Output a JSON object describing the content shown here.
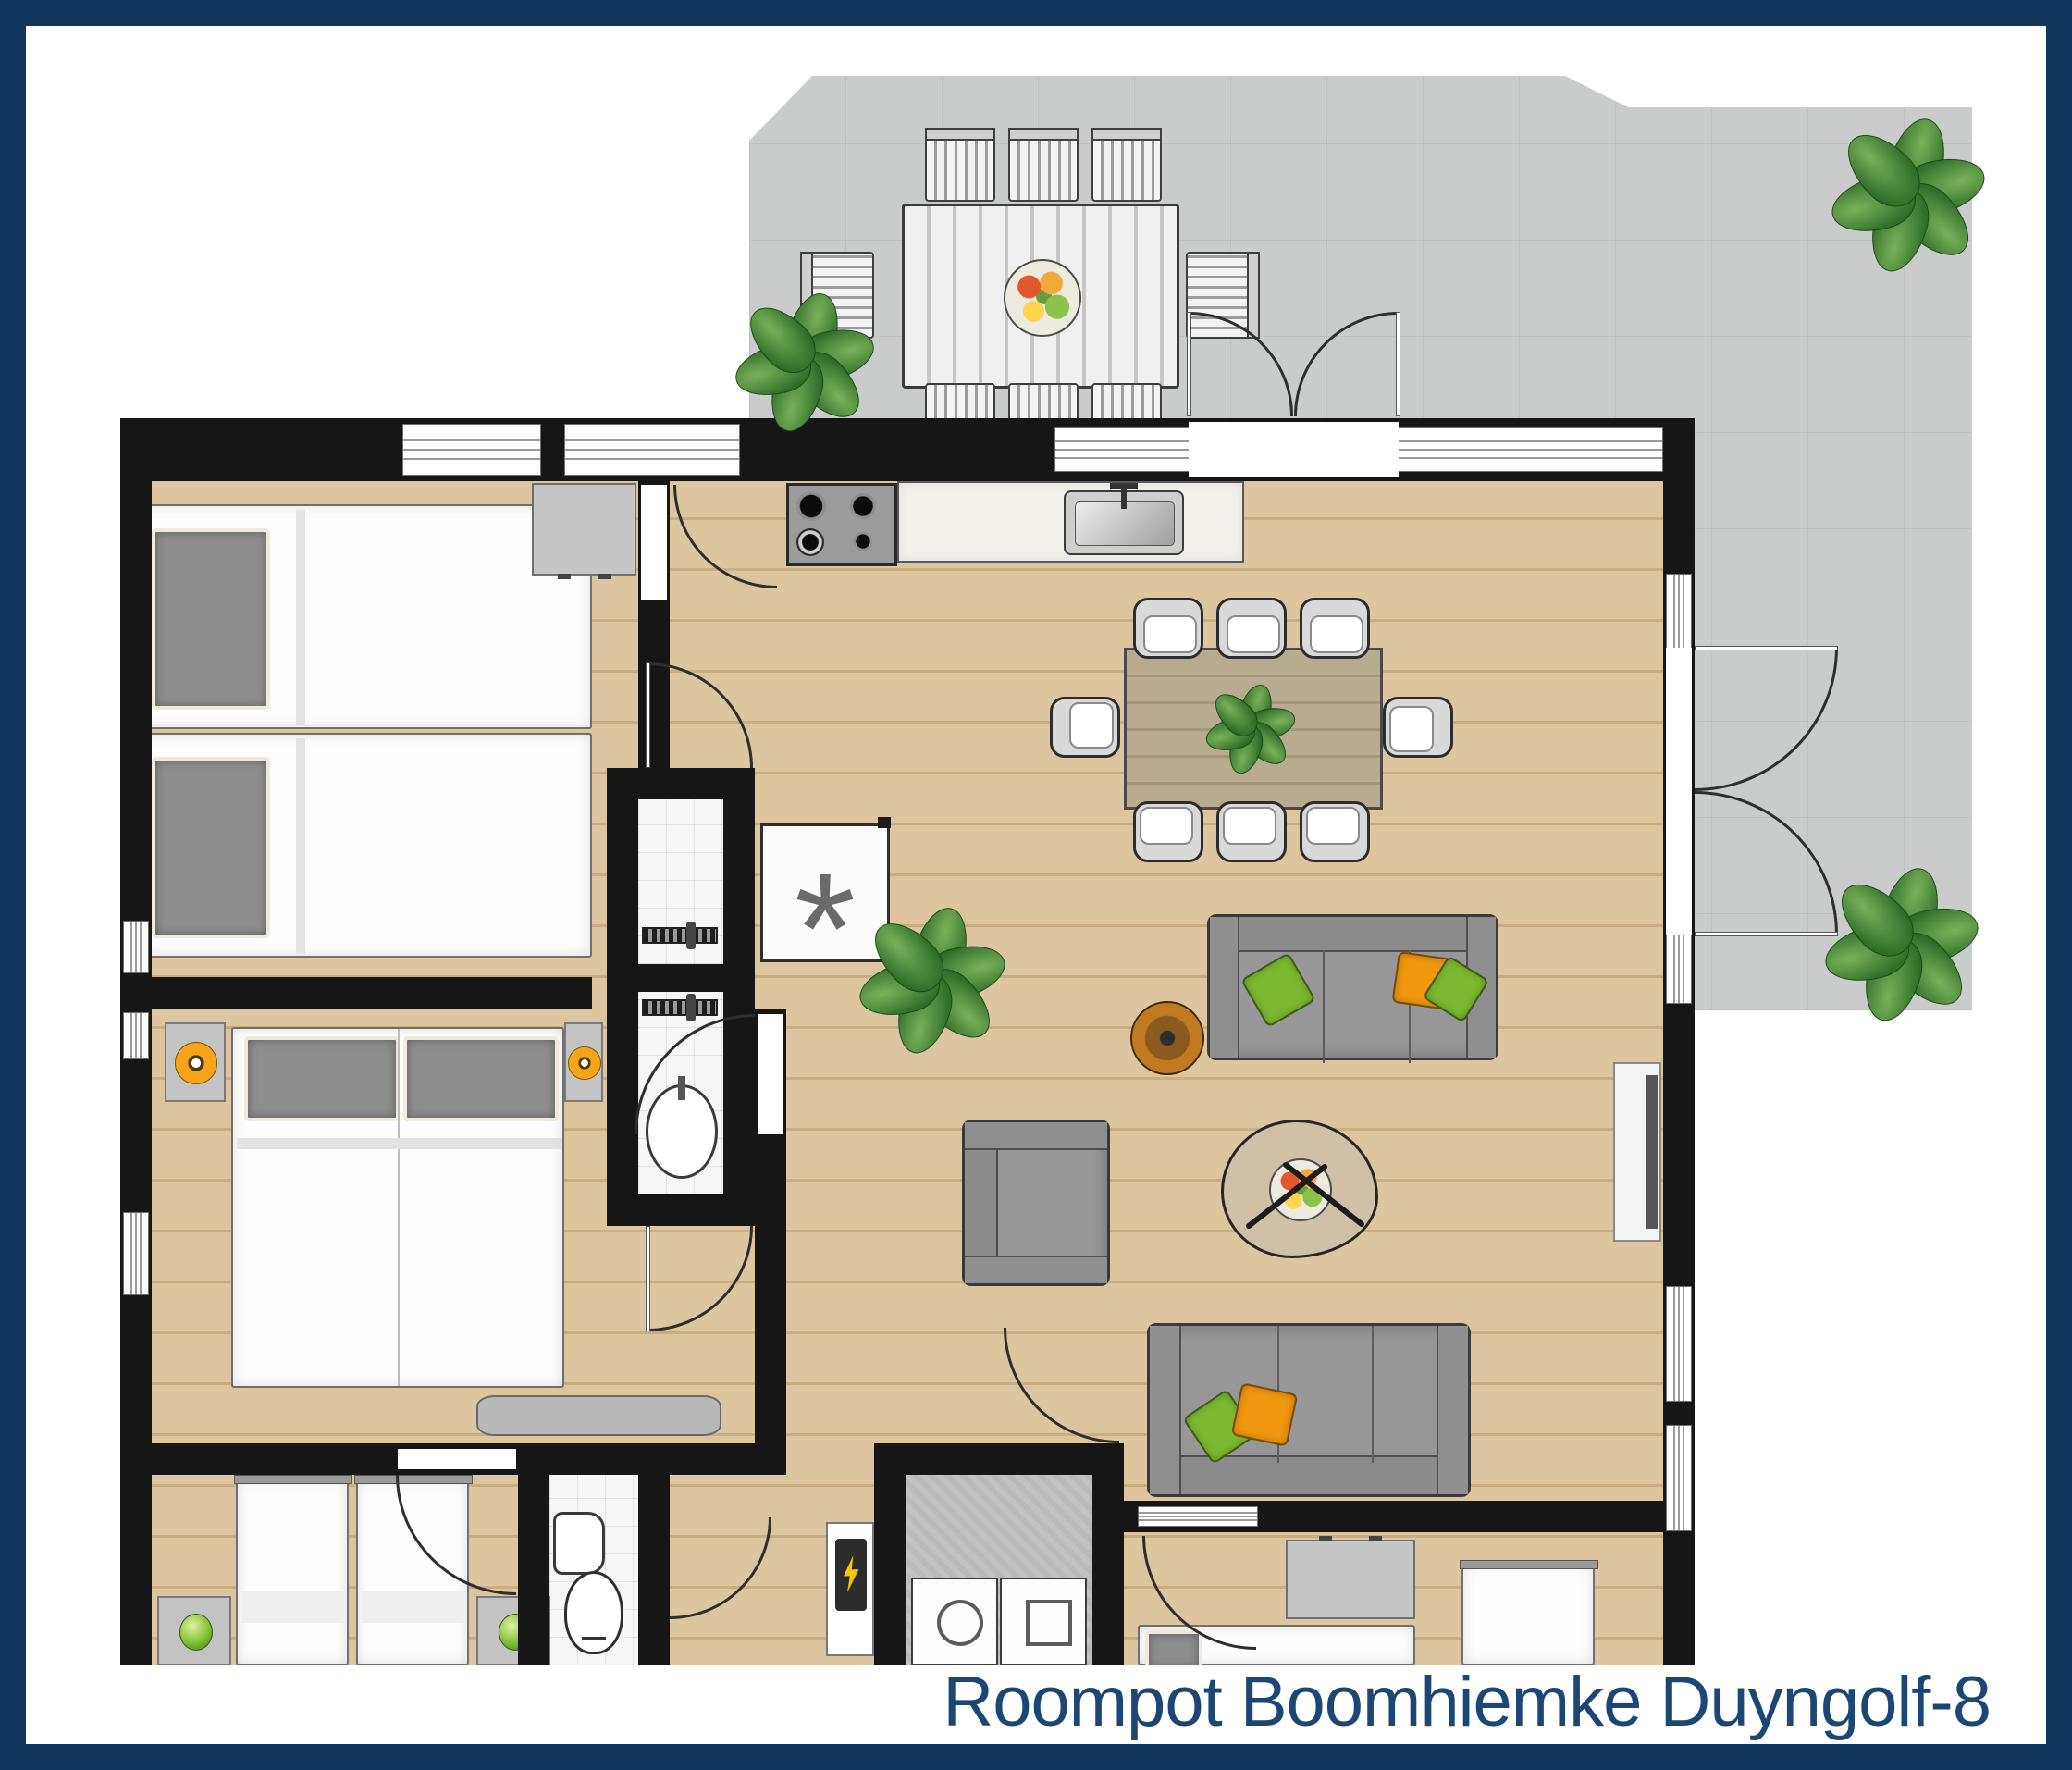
{
  "title": {
    "text": "Roompot Boomhiemke Duyngolf-8"
  },
  "symbols": {
    "freezer": "*"
  },
  "colors": {
    "frame": "#12375f",
    "title_text": "#1b4775",
    "wall": "#161616",
    "wood_floor": "#d9c29b",
    "terrace_tiles": "#c9cccb",
    "bathroom_tiles": "#f6f6f6",
    "utility_floor": "#b9bab9",
    "cushion_green": "#7cb82f",
    "cushion_orange": "#f0960f",
    "lamp_orange": "#f6a41a",
    "lamp_green": "#76b82a"
  },
  "floorplan": {
    "type": "holiday-home-top-view",
    "rooms": [
      {
        "name": "terrace",
        "floor": "grey-tiles",
        "furniture": [
          "outdoor-dining-table",
          "eight-outdoor-chairs",
          "fruit-plate",
          "plant",
          "plant",
          "plant"
        ]
      },
      {
        "name": "living-dining-room",
        "floor": "wood",
        "furniture": [
          "dining-table",
          "eight-dining-chairs",
          "table-plant",
          "sofa",
          "sofa",
          "armchair",
          "organic-coffee-table",
          "fruit-bowl",
          "round-side-table",
          "tv",
          "freezer",
          "floor-plant"
        ]
      },
      {
        "name": "kitchen",
        "floor": "wood",
        "furniture": [
          "cabinet",
          "gas-hob",
          "counter-with-sink"
        ]
      },
      {
        "name": "bedroom-top-left",
        "floor": "wood",
        "furniture": [
          "single-bed",
          "single-bed"
        ]
      },
      {
        "name": "bedroom-middle-left",
        "floor": "wood",
        "furniture": [
          "double-bed",
          "nightstand-orange-lamp",
          "nightstand-orange-lamp",
          "wall-shelf"
        ]
      },
      {
        "name": "bedroom-bottom-left",
        "floor": "wood",
        "furniture": [
          "single-bed",
          "single-bed",
          "nightstand-green-lamp",
          "nightstand-green-lamp"
        ]
      },
      {
        "name": "bedroom-bottom-right",
        "floor": "wood",
        "furniture": [
          "single-bed",
          "single-bed",
          "dresser"
        ]
      },
      {
        "name": "shower-room",
        "floor": "white-tiles",
        "furniture": [
          "shower",
          "shower",
          "washbasin"
        ]
      },
      {
        "name": "toilet-room",
        "floor": "white-tiles",
        "furniture": [
          "washbasin",
          "toilet"
        ]
      },
      {
        "name": "utility-room",
        "floor": "concrete",
        "furniture": [
          "washing-machine",
          "dryer",
          "electrical-panel"
        ]
      },
      {
        "name": "hallway",
        "floor": "wood",
        "furniture": []
      }
    ]
  }
}
